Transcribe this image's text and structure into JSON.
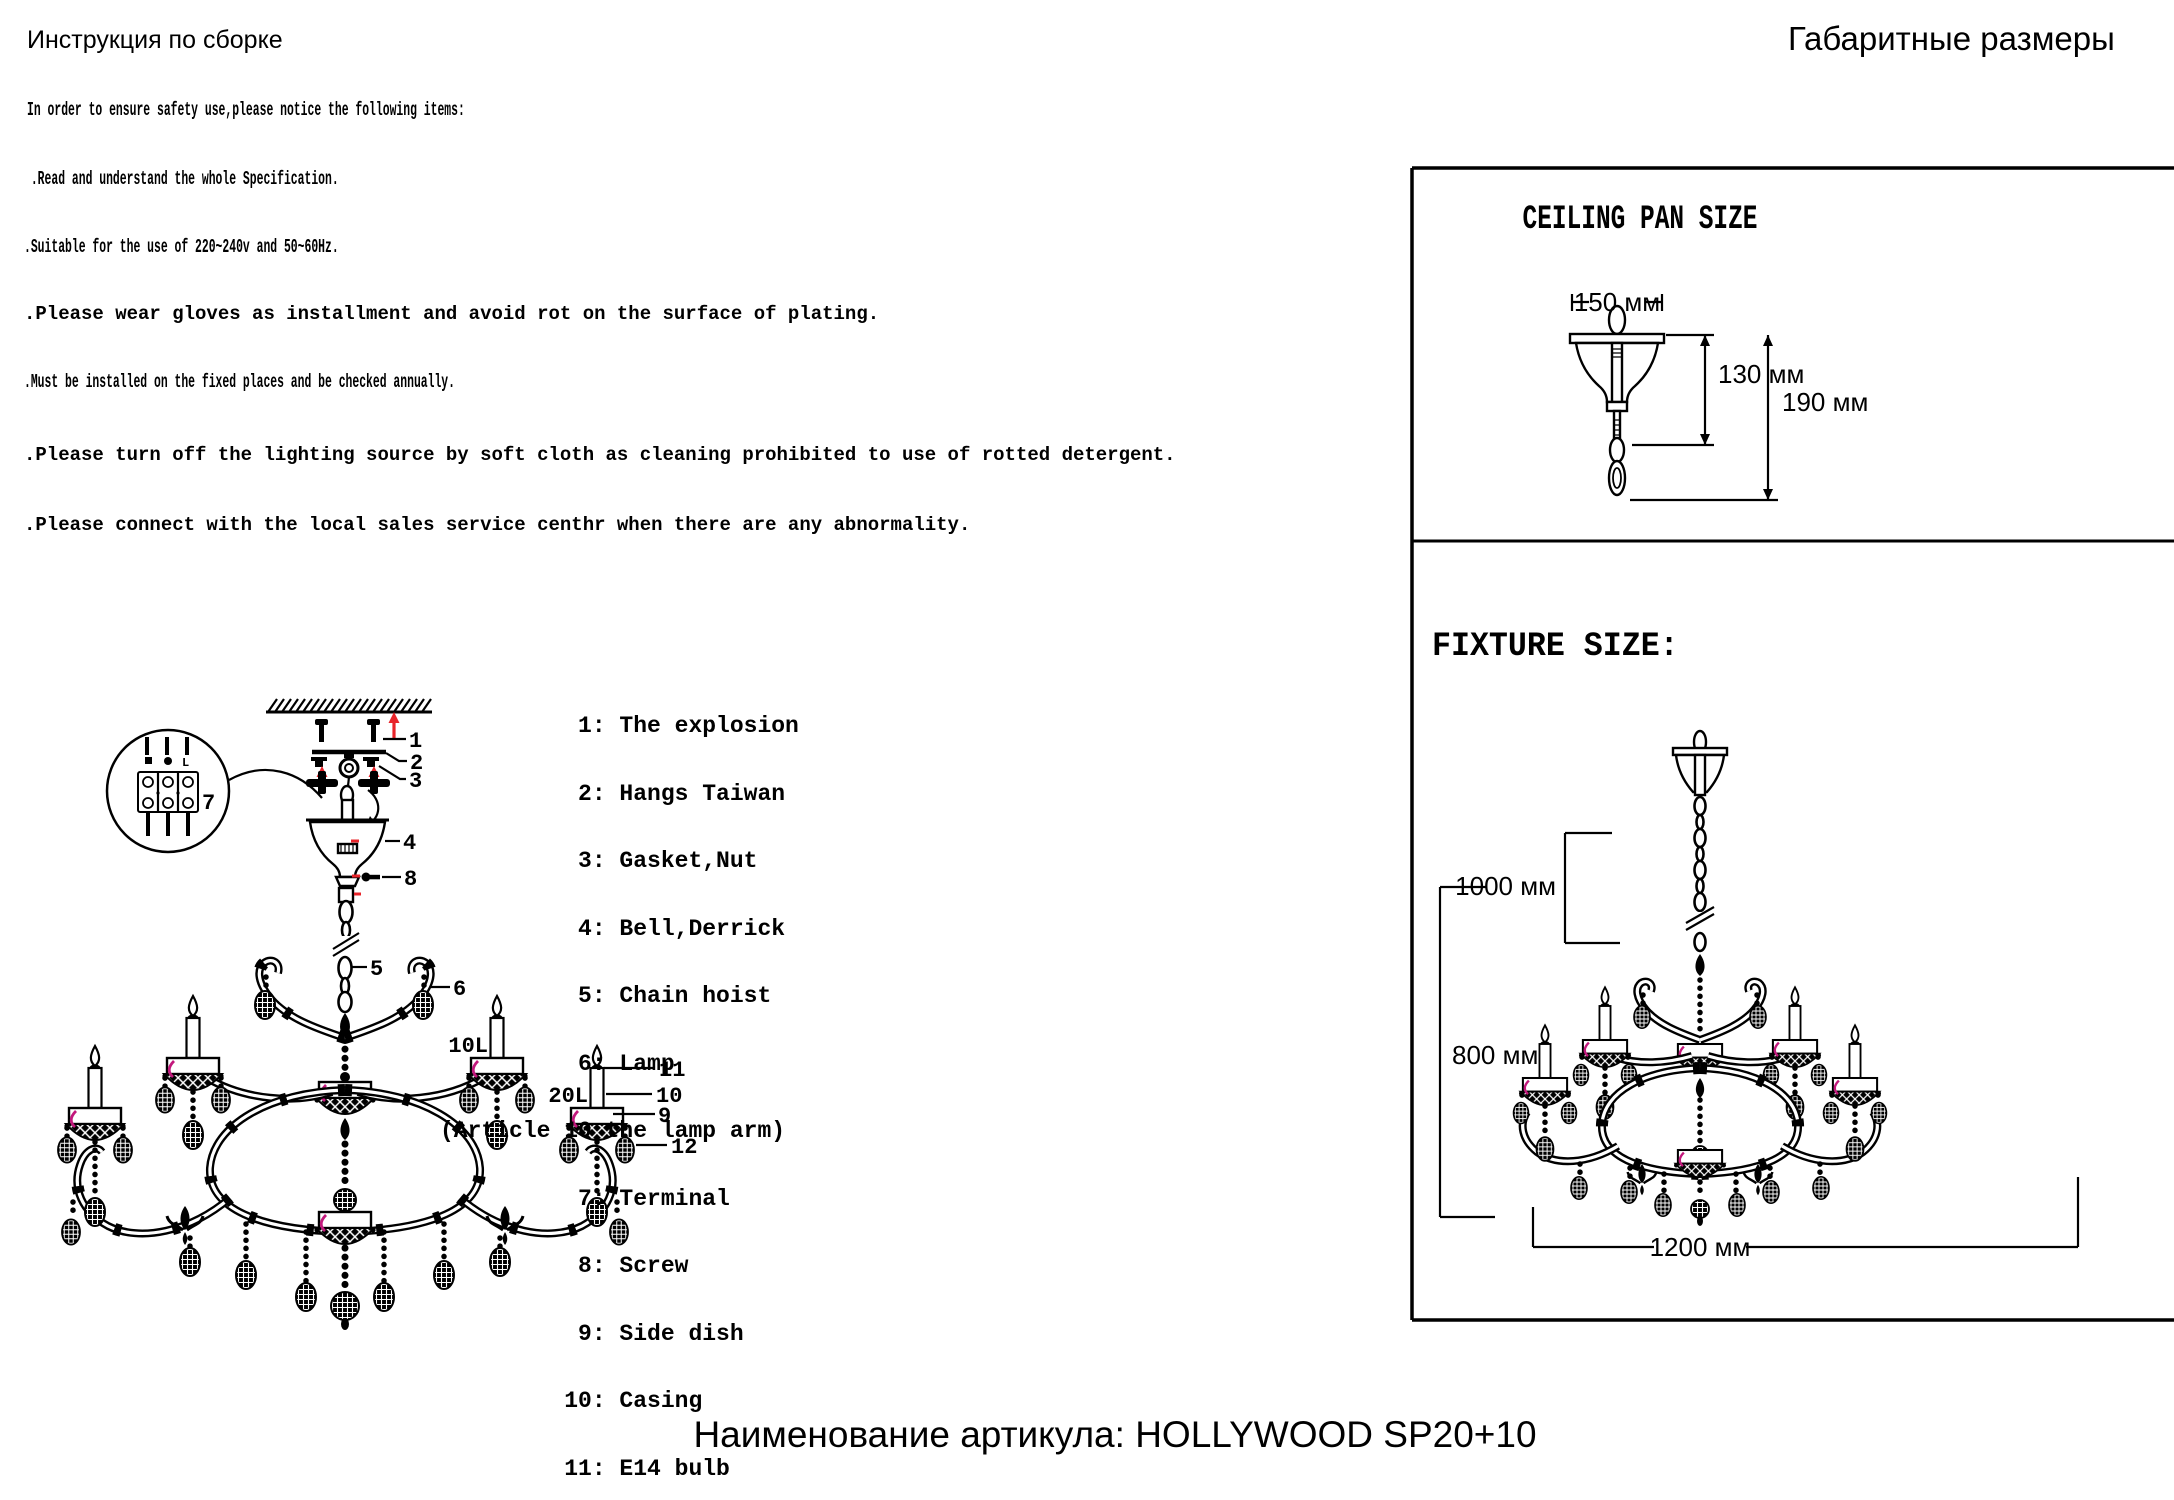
{
  "page": {
    "title_left": "Инструкция по сборке",
    "title_right": "Габаритные размеры",
    "footer": "Наименование артикула: HOLLYWOOD SP20+10"
  },
  "safety": {
    "intro": "In order to ensure safety use,please notice the following items:",
    "items": [
      " .Read and understand the whole Specification.",
      ".Suitable for the use of 220~240v and 50~60Hz.",
      ".Please wear gloves as installment and avoid rot on the surface of plating.",
      ".Must be installed on the fixed places and be checked annually.",
      ".Please turn off the lighting source by soft cloth as cleaning prohibited to use of rotted detergent.",
      ".Please connect with the local sales service centhr when there are any abnormality."
    ]
  },
  "parts": {
    "lines": [
      "          1: The explosion",
      "          2: Hangs Taiwan",
      "          3: Gasket,Nut",
      "          4: Bell,Derrick",
      "          5: Chain hoist",
      "          6: Lamp",
      "(Article 10 the lamp arm)",
      "          7: Terminal",
      "          8: Screw",
      "          9: Side dish",
      "         10: Casing",
      "         11: E14 bulb",
      "         12: Crystal"
    ]
  },
  "assembly": {
    "callouts": {
      "n1": "1",
      "n2": "2",
      "n3": "3",
      "n4": "4",
      "n5": "5",
      "n6": "6",
      "n7": "7",
      "n8": "8",
      "n9": "9",
      "n10": "10",
      "n11": "11",
      "n12": "12",
      "l10": "10L",
      "l20": "20L"
    },
    "terminal_l": "L"
  },
  "panel": {
    "ceiling": {
      "title": "CEILING PAN SIZE",
      "dim_width": "150 мм",
      "dim_h1": "130 мм",
      "dim_h2": "190 мм"
    },
    "fixture": {
      "title": "FIXTURE SIZE:",
      "dim_chain": "1000 мм",
      "dim_height": "800 мм",
      "dim_width": "1200 мм"
    }
  },
  "colors": {
    "ink": "#000000",
    "red": "#e8242a",
    "magenta": "#c2187c"
  }
}
